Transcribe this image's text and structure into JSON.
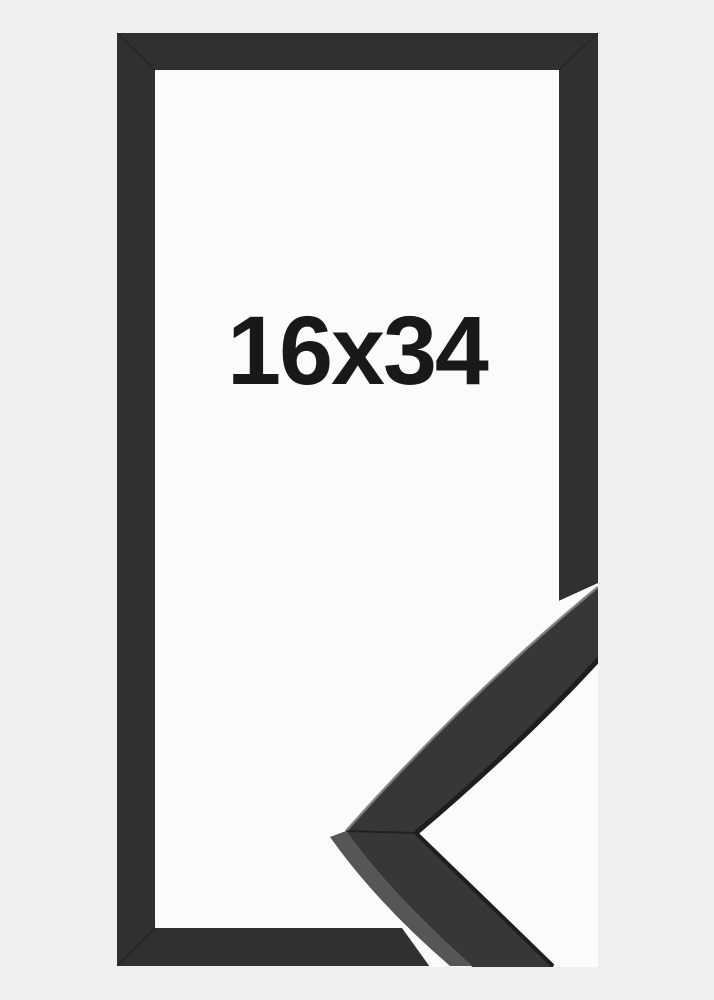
{
  "product": {
    "size_label": "16x34"
  },
  "colors": {
    "background": "#f0eff0",
    "interior": "#fbfbfb",
    "cutout": "#fbfbfb",
    "frame": "#303030",
    "sample_face": "#373737",
    "sample_side": "#565656",
    "sample_edge_highlight": "#7d7d7d",
    "sample_lip": "#1e1e1e",
    "label_text": "#191919"
  }
}
